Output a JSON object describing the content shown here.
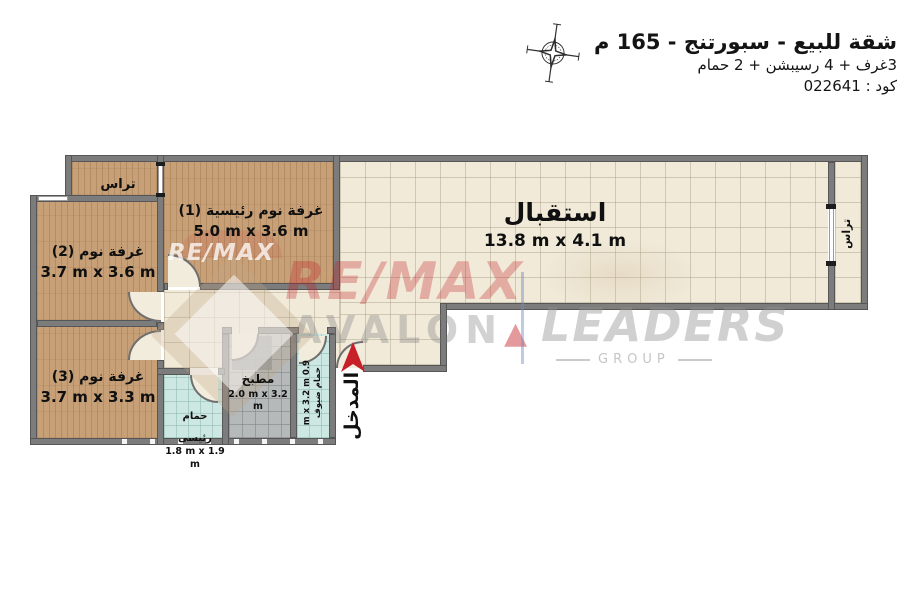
{
  "header": {
    "title": "شقة للبيع - سبورتنج - 165 م",
    "subtitle": "3غرف + 4 رسيبشن + 2 حمام",
    "code": "كود : 022641"
  },
  "rooms": {
    "reception": {
      "name": "استقبال",
      "dims": "13.8 m x 4.1 m"
    },
    "master_bedroom": {
      "name": "غرفة نوم رئيسية (1)",
      "dims": "5.0 m x 3.6 m"
    },
    "bedroom_2": {
      "name": "غرفة نوم (2)",
      "dims": "3.7 m x 3.6 m"
    },
    "bedroom_3": {
      "name": "غرفة نوم (3)",
      "dims": "3.7 m x 3.3 m"
    },
    "kitchen": {
      "name": "مطبخ",
      "dims": "2.0 m x 3.2 m"
    },
    "master_bathroom": {
      "name": "حمام رئيسى",
      "dims": "1.8 m x 1.9 m"
    },
    "guest_bathroom": {
      "name": "حمام ضيوف",
      "dims": "0.9 m x 3.2 m"
    },
    "terrace_top_left": {
      "name": "تراس"
    },
    "terrace_right": {
      "name": "تراس"
    },
    "entrance": {
      "name": "المدخل"
    }
  },
  "watermarks": {
    "remax_white": "RE/MAX",
    "remax_red": "RE/MAX",
    "avalon": "AVALON",
    "avalon_triangle": "▲",
    "leaders": "LEADERS",
    "group": "GROUP"
  },
  "colors": {
    "wall": "#7c7c7c",
    "wood_floor": "#c7a077",
    "tile_floor": "#f1ead9",
    "bath_floor": "#cde8e2",
    "kitchen_floor": "#b5b9b9",
    "accent_red": "#c8202a"
  }
}
